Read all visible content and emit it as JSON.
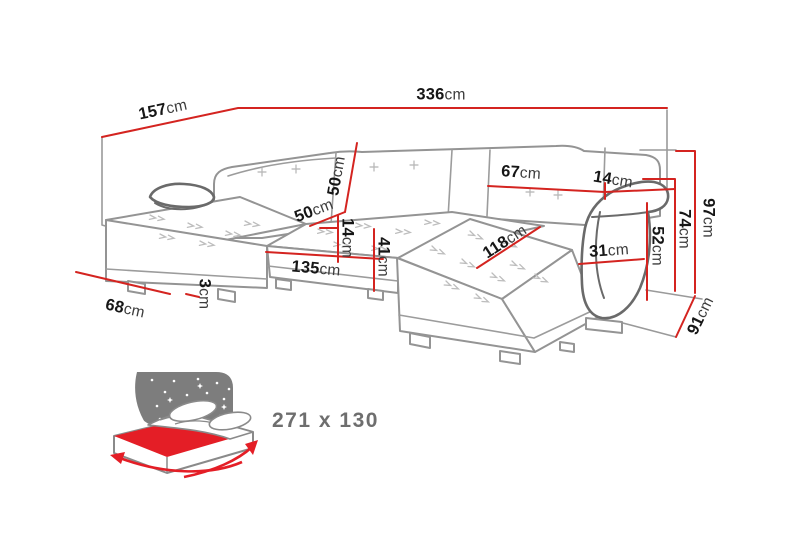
{
  "diagram": {
    "type": "U-shaped corner sofa dimension drawing",
    "dimensions": [
      {
        "id": "total-width-top",
        "value": "336",
        "unit": "cm"
      },
      {
        "id": "left-side-depth",
        "value": "157",
        "unit": "cm"
      },
      {
        "id": "total-height",
        "value": "97",
        "unit": "cm"
      },
      {
        "id": "backrest-height",
        "value": "74",
        "unit": "cm"
      },
      {
        "id": "armrest-height",
        "value": "52",
        "unit": "cm"
      },
      {
        "id": "right-side-depth",
        "value": "91",
        "unit": "cm"
      },
      {
        "id": "backrest-cushion-width",
        "value": "67",
        "unit": "cm"
      },
      {
        "id": "corner-segment-width",
        "value": "14",
        "unit": "cm"
      },
      {
        "id": "backrest-cushion-height",
        "value": "50",
        "unit": "cm"
      },
      {
        "id": "seat-depth",
        "value": "50",
        "unit": "cm"
      },
      {
        "id": "seat-cushion-thickness",
        "value": "14",
        "unit": "cm"
      },
      {
        "id": "seat-height",
        "value": "41",
        "unit": "cm"
      },
      {
        "id": "center-seat-width",
        "value": "135",
        "unit": "cm"
      },
      {
        "id": "chaise-seat-length",
        "value": "118",
        "unit": "cm"
      },
      {
        "id": "armrest-width",
        "value": "31",
        "unit": "cm"
      },
      {
        "id": "chaise-outer-width",
        "value": "68",
        "unit": "cm"
      },
      {
        "id": "base-clearance",
        "value": "3",
        "unit": "cm"
      }
    ],
    "sleeping_function": {
      "size_label": "271 x 130"
    },
    "colors": {
      "background": "#ffffff",
      "dimension_line": "#d42420",
      "number_text": "#161616",
      "unit_text": "#3c3c3c",
      "sketch_stroke": "#949494",
      "armrest_stroke": "#6a6a6a",
      "pattern_mark": "#bdbdbd",
      "icon_panel_gray": "#7d7d7d",
      "mattress_red": "#e41e26",
      "size_text": "#6e6e6e"
    }
  }
}
